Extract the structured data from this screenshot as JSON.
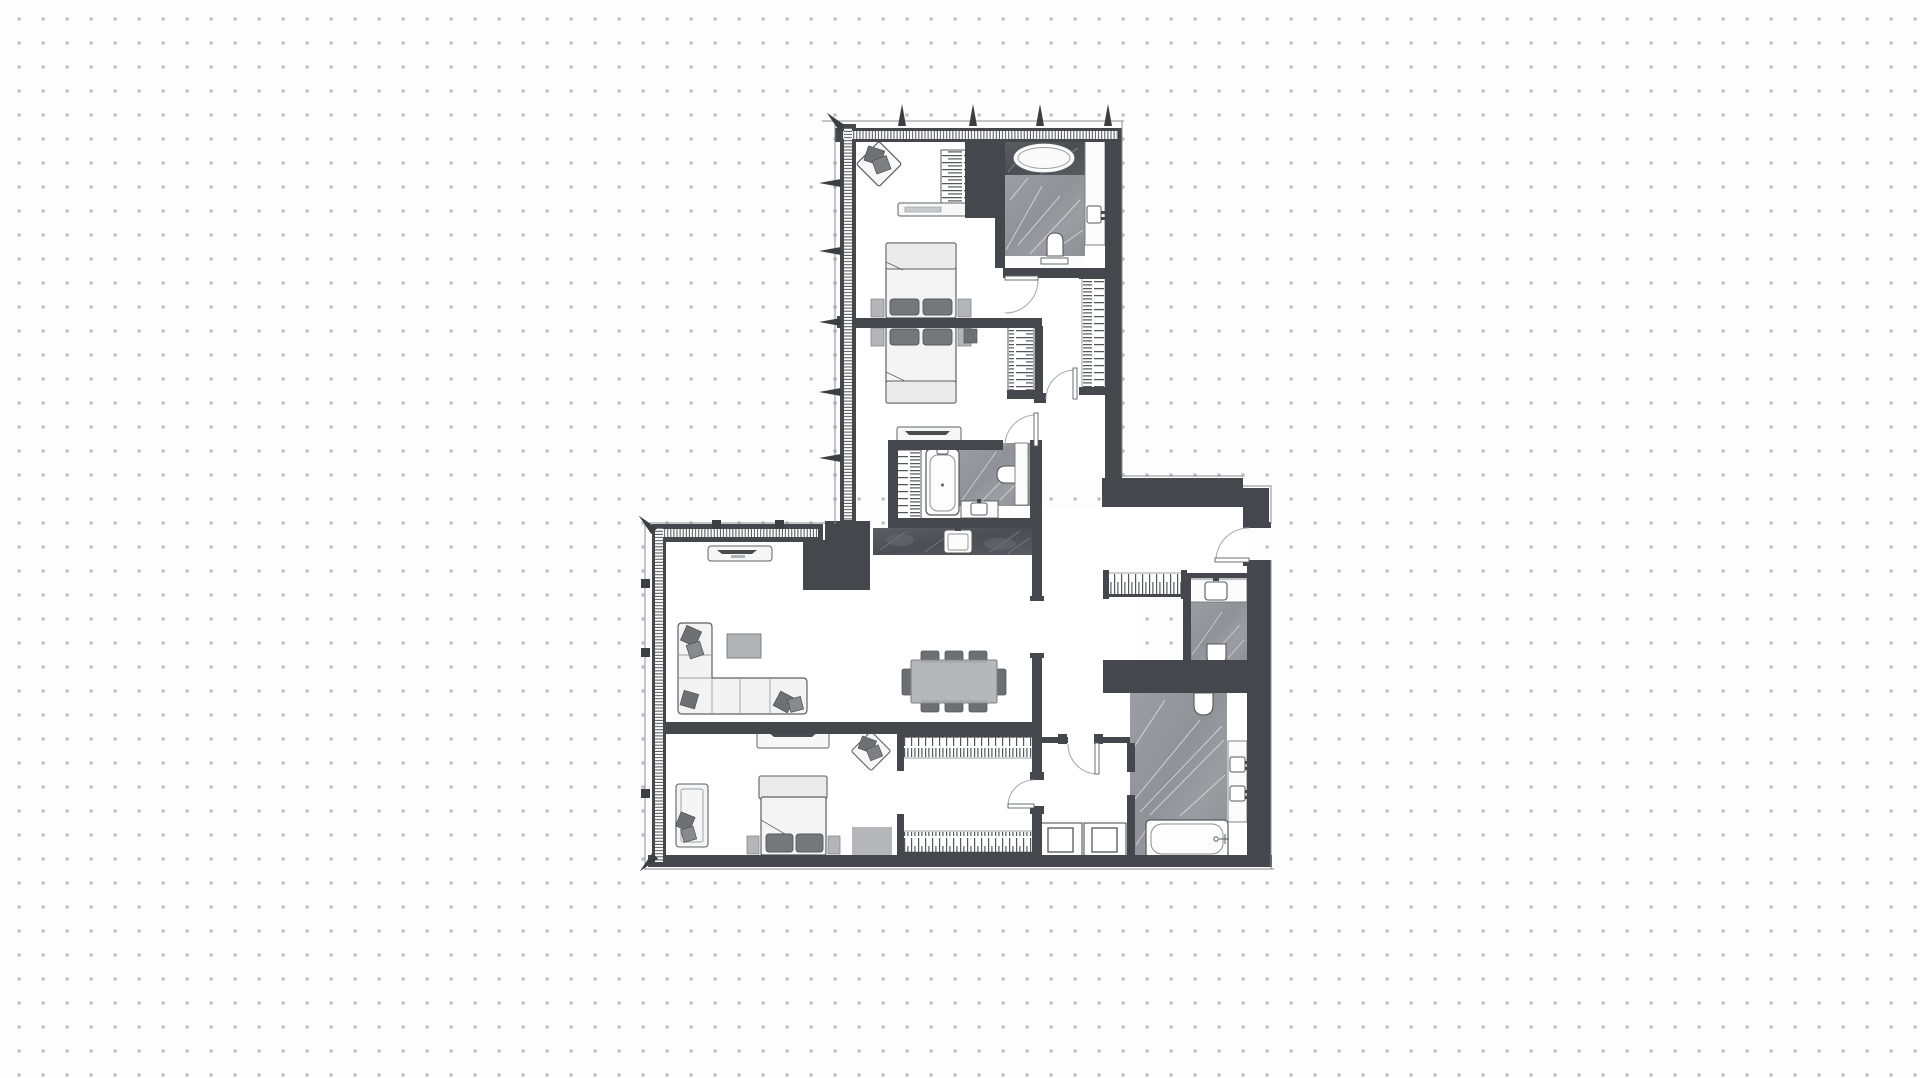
{
  "page": {
    "background": {
      "color": "#fdfdfd",
      "dot_color": "#c2c3c5",
      "dot_spacing_px": 24
    }
  },
  "floor_plan": {
    "aria_label": "Apartment floor plan drawing",
    "style": "top-down architectural plan, grayscale",
    "colors": {
      "wall": "#44474b",
      "floor": "#ffffff",
      "glazing_tick": "#4b4e52",
      "furniture_outline": "#5d6063",
      "furniture_light": "#f5f5f6",
      "pillow_dark": "#6e7174",
      "mid_gray": "#b5b7ba",
      "marble_light": "#96999d",
      "marble_dark": "#54575b",
      "door_arc": "#a8adb2"
    },
    "rooms": [
      {
        "name": "master-bedroom",
        "fixtures": [
          "double-bed",
          "two-pillows",
          "two-nightstands",
          "accent-armchair",
          "shelving-closet",
          "low-desk"
        ]
      },
      {
        "name": "ensuite-bathroom",
        "fixtures": [
          "oval-bathtub",
          "vanity-counter",
          "sink",
          "toilet",
          "shelf"
        ]
      },
      {
        "name": "bedroom-2",
        "fixtures": [
          "double-bed",
          "two-pillows",
          "two-nightstands",
          "wardrobe",
          "dresser"
        ]
      },
      {
        "name": "family-bathroom",
        "fixtures": [
          "bathtub",
          "toilet",
          "vanity-sink",
          "linen-wardrobe"
        ]
      },
      {
        "name": "kitchen",
        "fixtures": [
          "stone-counter",
          "sink"
        ]
      },
      {
        "name": "living-dining",
        "fixtures": [
          "corner-sofa",
          "five-cushions",
          "coffee-table",
          "tv-console",
          "dining-table",
          "eight-chairs"
        ]
      },
      {
        "name": "bedroom-3",
        "fixtures": [
          "double-bed",
          "bench",
          "chaise-lounge",
          "tv-console",
          "accent-armchair",
          "rug",
          "two-nightstands"
        ]
      },
      {
        "name": "walk-in-closet",
        "fixtures": [
          "shelf-row-north",
          "shelf-row-south"
        ]
      },
      {
        "name": "hallway",
        "fixtures": [
          "door-to-closet",
          "door-to-bath-lobby"
        ]
      },
      {
        "name": "entry-hall",
        "fixtures": [
          "entry-door",
          "shoe-shelf"
        ]
      },
      {
        "name": "guest-wc",
        "fixtures": [
          "vanity-sink",
          "toilet",
          "mat"
        ]
      },
      {
        "name": "master-bathroom",
        "fixtures": [
          "bathtub",
          "double-vanity",
          "two-sinks",
          "toilet"
        ]
      },
      {
        "name": "laundry",
        "fixtures": [
          "washer",
          "dryer"
        ]
      },
      {
        "name": "corridor",
        "fixtures": [
          "tall-wardrobe"
        ]
      }
    ],
    "counts": {
      "bedrooms": 3,
      "bathrooms": 3,
      "wc": 1,
      "dining_seats": 8,
      "window_mullion_markers_top": 5,
      "window_mullion_markers_left": 5
    }
  }
}
